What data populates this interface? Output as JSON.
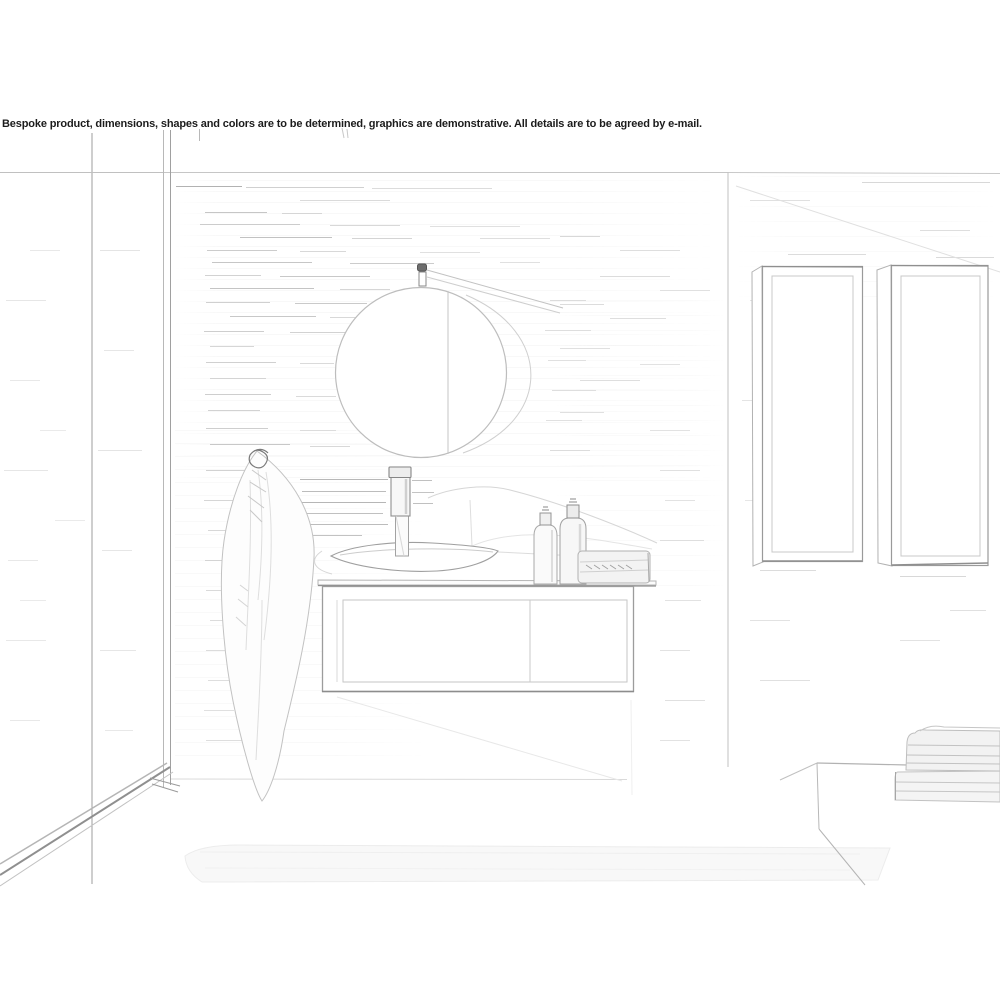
{
  "disclaimer": "Bespoke product, dimensions, shapes and colors are to be determined, graphics are demonstrative. All details are to be agreed by e-mail.",
  "scene": {
    "type": "pencil-sketch rendering",
    "setting": "bathroom interior",
    "objects": [
      "shower-glass-partition",
      "tiled-feature-wall",
      "round-wall-mirror-with-hanger-strap",
      "towel-hanging-on-wall-hook",
      "wall-hung-vanity-cabinet",
      "countertop-vessel-basin",
      "tall-basin-mixer-tap",
      "soap-dispenser-bottles",
      "folded-towels-on-countertop",
      "tall-wall-cabinet-left",
      "tall-wall-cabinet-right",
      "bench-with-stacked-towels",
      "bath-mat"
    ]
  },
  "colors": {
    "background": "#ffffff",
    "sketch_line_dark": "#8f8f8f",
    "sketch_line_mid": "#aeaeae",
    "sketch_line_light": "#d6d6d6",
    "text": "#1c1c1c"
  }
}
